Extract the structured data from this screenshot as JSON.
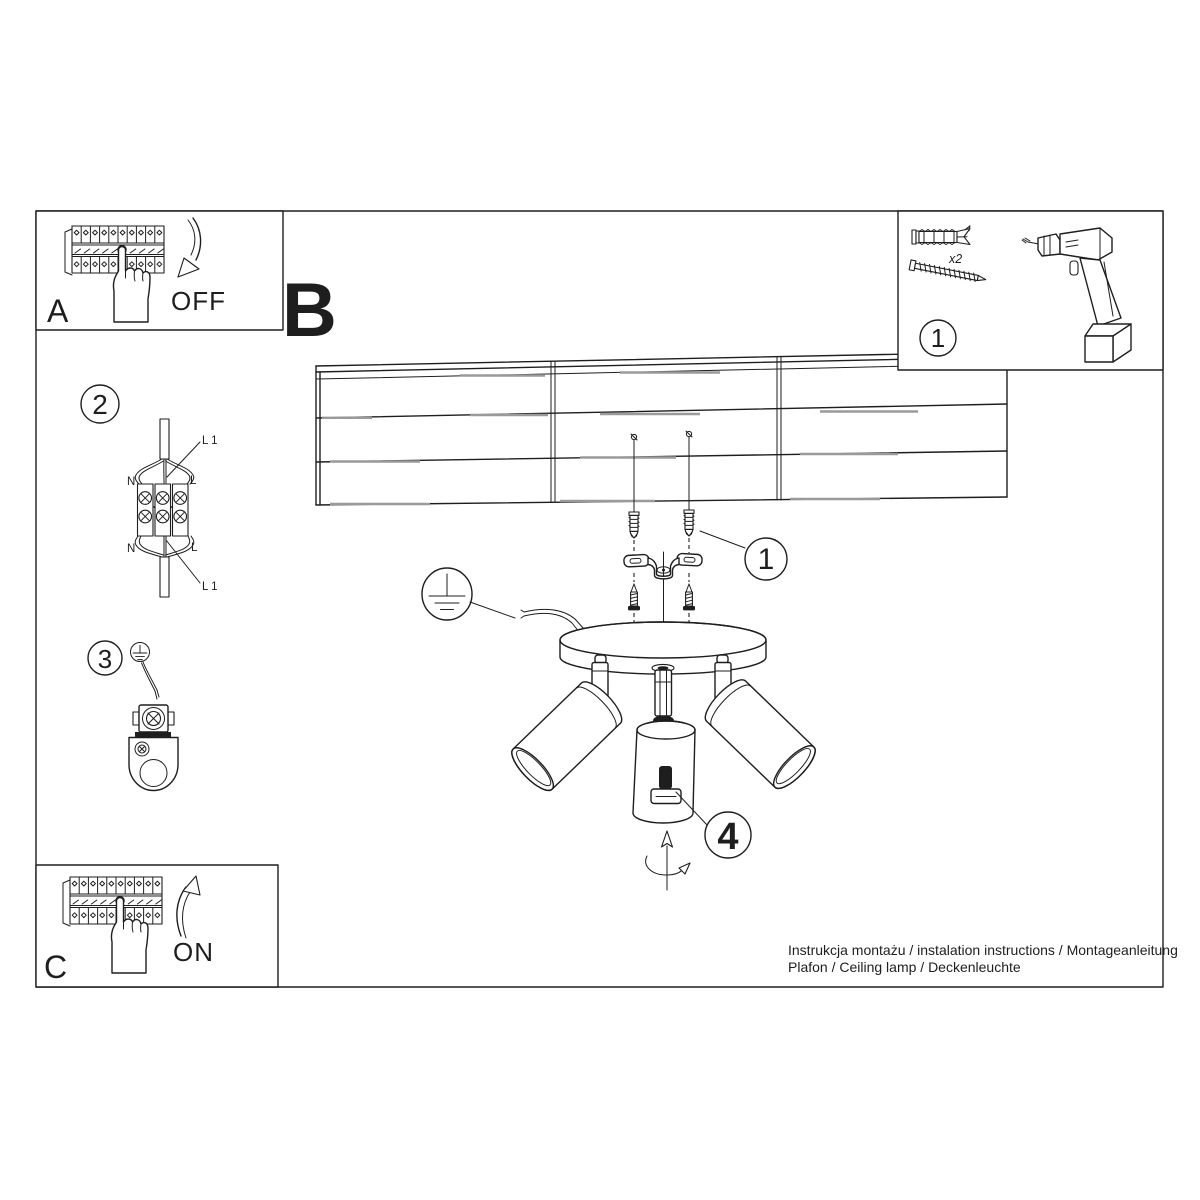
{
  "colors": {
    "ink": "#1e1e1e",
    "gray": "#9a9a9a",
    "background": "#ffffff"
  },
  "panel_a": {
    "letter": "A",
    "state": "OFF"
  },
  "panel_b": {
    "letter": "B"
  },
  "panel_c": {
    "letter": "C",
    "state": "ON"
  },
  "tools_box": {
    "number": "1",
    "anchor_qty": "x2"
  },
  "callouts": {
    "mount": "1",
    "wiring": "2",
    "ground": "3",
    "adjust": "4"
  },
  "wiring": {
    "n_top": "N",
    "l_top": "L",
    "l1_top": "L 1",
    "n_bottom": "N",
    "l_bottom": "L",
    "l1_bottom": "L 1"
  },
  "footer": {
    "line1": "Instrukcja montażu / instalation instructions / Montageanleitung",
    "line2": "Plafon / Ceiling lamp / Deckenleuchte"
  }
}
